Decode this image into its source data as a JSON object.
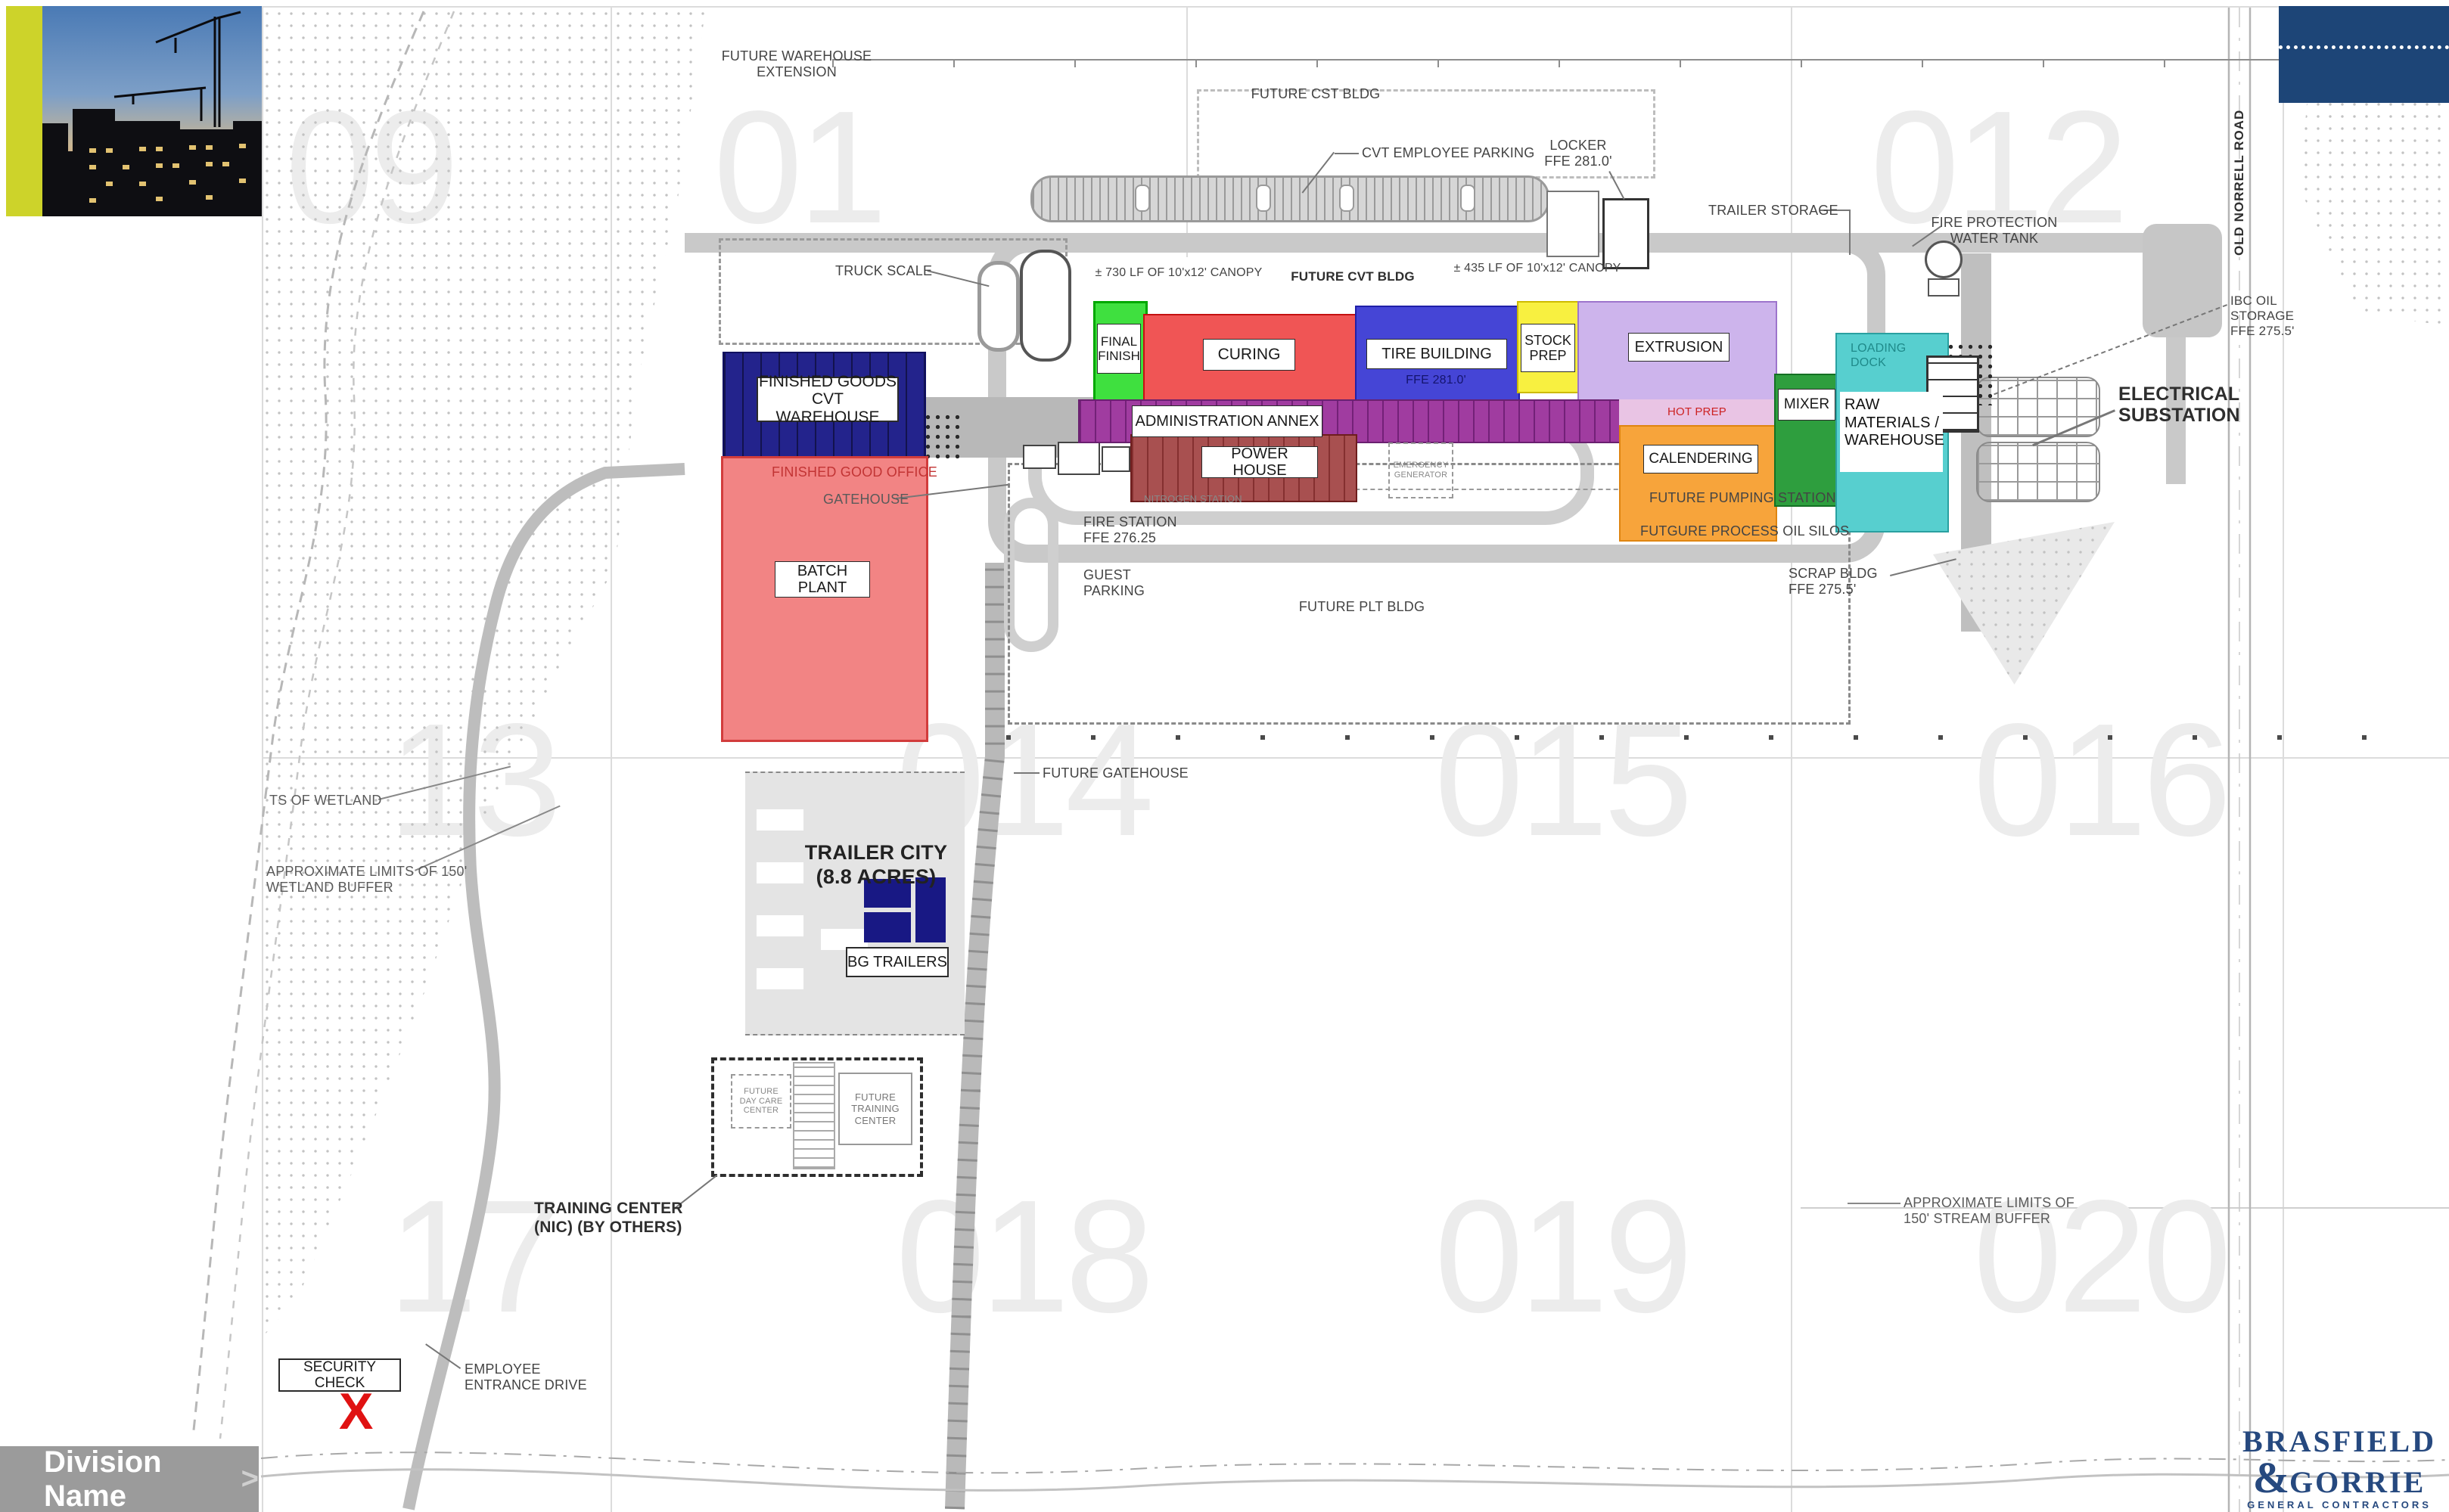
{
  "slide": {
    "division_name": "Division Name",
    "division_chevron": ">",
    "logo": {
      "name_top": "BRASFIELD",
      "amp": "&",
      "name_bottom": "GORRIE",
      "tagline": "GENERAL CONTRACTORS"
    }
  },
  "plan": {
    "grid_refs": {
      "r1": [
        "09",
        "01",
        "012"
      ],
      "r2": [
        "13",
        "014",
        "015",
        "016"
      ],
      "r3": [
        "17",
        "018",
        "019",
        "020"
      ]
    },
    "buildings": {
      "finished_goods": "FINISHED GOODS\nCVT WAREHOUSE",
      "batch_plant": "BATCH PLANT",
      "final_finish": "FINAL\nFINISH",
      "curing": "CURING",
      "tire_building": "TIRE BUILDING",
      "tire_ffe": "FFE 281.0'",
      "stock_prep": "STOCK\nPREP",
      "extrusion": "EXTRUSION",
      "admin_annex": "ADMINISTRATION ANNEX",
      "hot_prep": "HOT PREP",
      "calendering": "CALENDERING",
      "mixer": "MIXER",
      "raw_materials": "RAW\nMATERIALS /\nWAREHOUSE",
      "loading_dock": "LOADING\nDOCK",
      "power_house": "POWER HOUSE",
      "emergency_generator": "EMERGENCY\nGENERATOR",
      "trailer_city": "TRAILER CITY\n(8.8 ACRES)",
      "bg_trailers": "BG TRAILERS",
      "future_day_care": "FUTURE\nDAY CARE\nCENTER",
      "future_training": "FUTURE\nTRAINING\nCENTER"
    },
    "labels": {
      "future_warehouse_extension": "FUTURE WAREHOUSE\nEXTENSION",
      "future_cst_bldg": "FUTURE CST BLDG",
      "cvt_employee_parking": "CVT EMPLOYEE PARKING",
      "locker": "LOCKER\nFFE 281.0'",
      "trailer_storage": "TRAILER STORAGE",
      "fire_protection_water_tank": "FIRE PROTECTION\nWATER TANK",
      "ibc_oil_storage": "IBC OIL\nSTORAGE\nFFE 275.5'",
      "old_norrell_road": "OLD NORRELL ROAD",
      "electrical_substation": "ELECTRICAL\nSUBSTATION",
      "truck_scale": "TRUCK SCALE",
      "canopy_730": "± 730 LF OF 10'x12' CANOPY",
      "future_cvt_bldg": "FUTURE CVT BLDG",
      "canopy_435": "± 435 LF OF 10'x12' CANOPY",
      "finished_good_office": "FINISHED GOOD OFFICE",
      "gatehouse": "GATEHOUSE",
      "fire_station": "FIRE STATION\nFFE 276.25",
      "guest_parking": "GUEST\nPARKING",
      "nitrogen_station": "NITROGEN STATION",
      "future_plt_bldg": "FUTURE PLT BLDG",
      "future_pumping_station": "FUTURE PUMPING STATION",
      "future_process_oil_silos": "FUTGURE PROCESS OIL SILOS",
      "scrap_bldg": "SCRAP BLDG\nFFE 275.5'",
      "future_gatehouse": "FUTURE GATEHOUSE",
      "limits_of_wetland": "TS OF WETLAND",
      "wetland_buffer": "APPROXIMATE LIMITS OF 150'\nWETLAND BUFFER",
      "stream_buffer": "APPROXIMATE LIMITS OF\n150' STREAM BUFFER",
      "training_center_nic": "TRAINING CENTER\n(NIC) (BY OTHERS)",
      "security_check": "SECURITY CHECK",
      "employee_entrance_drive": "EMPLOYEE\nENTRANCE DRIVE",
      "x_marker": "X"
    },
    "colors": {
      "final_finish": "#3fe03f",
      "curing": "#f05555",
      "tire_building": "#4545d6",
      "stock_prep": "#f8f040",
      "extrusion": "#cdb4ec",
      "admin_annex": "#a03ca0",
      "calendering": "#f7a43b",
      "mixer": "#2e9e3e",
      "raw_materials": "#57cfcf",
      "power_house": "#a85050",
      "batch_plant": "#f28484",
      "warehouse_navy": "#23238c",
      "trailer_navy": "#181884",
      "accent_yellow": "#cdd32a",
      "brand_navy": "#1d4577",
      "marker_red": "#e01212"
    }
  }
}
